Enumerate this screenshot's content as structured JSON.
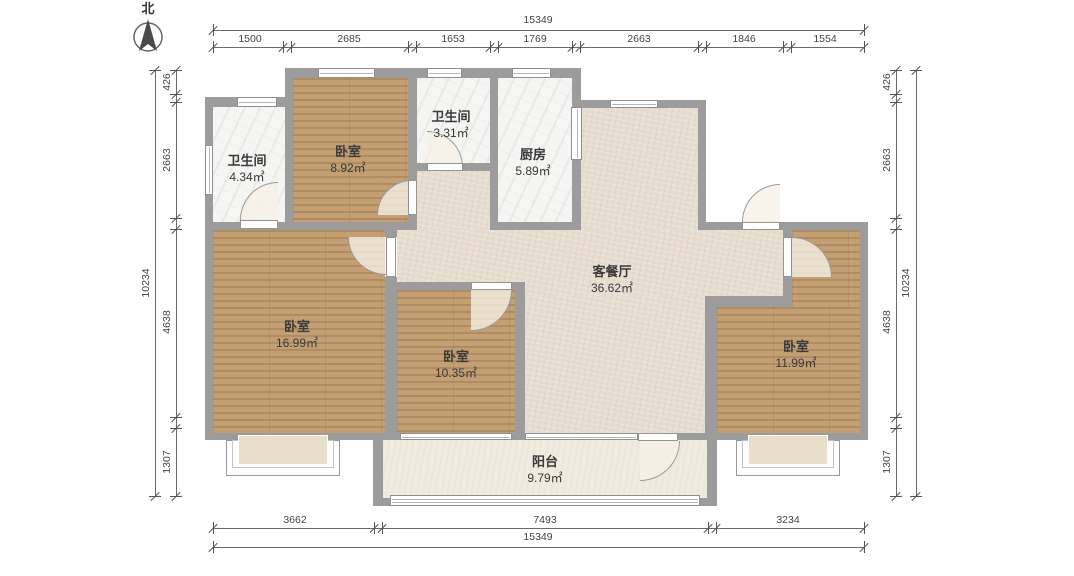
{
  "compass": {
    "label": "北"
  },
  "rooms": [
    {
      "id": "bath-left",
      "name": "卫生间",
      "area": "4.34㎡"
    },
    {
      "id": "bedroom-top",
      "name": "卧室",
      "area": "8.92㎡"
    },
    {
      "id": "bath-mid",
      "name": "卫生间",
      "area": "3.31㎡"
    },
    {
      "id": "kitchen",
      "name": "厨房",
      "area": "5.89㎡"
    },
    {
      "id": "living-dining",
      "name": "客餐厅",
      "area": "36.62㎡"
    },
    {
      "id": "bedroom-left",
      "name": "卧室",
      "area": "16.99㎡"
    },
    {
      "id": "bedroom-mid",
      "name": "卧室",
      "area": "10.35㎡"
    },
    {
      "id": "bedroom-right",
      "name": "卧室",
      "area": "11.99㎡"
    },
    {
      "id": "balcony",
      "name": "阳台",
      "area": "9.79㎡"
    }
  ],
  "dimensions": {
    "top": {
      "total": "15349",
      "segments": [
        "1500",
        "2685",
        "1653",
        "1769",
        "2663",
        "1846",
        "1554"
      ]
    },
    "bottom": {
      "total": "15349",
      "segments": [
        "3662",
        "7493",
        "3234"
      ]
    },
    "left": {
      "total": "10234",
      "segments": [
        "426",
        "2663",
        "4638",
        "1307"
      ]
    },
    "right": {
      "total": "10234",
      "segments": [
        "426",
        "2663",
        "4638",
        "1307"
      ]
    }
  },
  "colors": {
    "wall": "#9c9c9c",
    "wood_floor": "#c29d72",
    "living_floor": "#e6ddd0",
    "marble_floor": "#f5f5f3",
    "balcony_floor": "#f0ebdf",
    "dimension_text": "#444444"
  }
}
